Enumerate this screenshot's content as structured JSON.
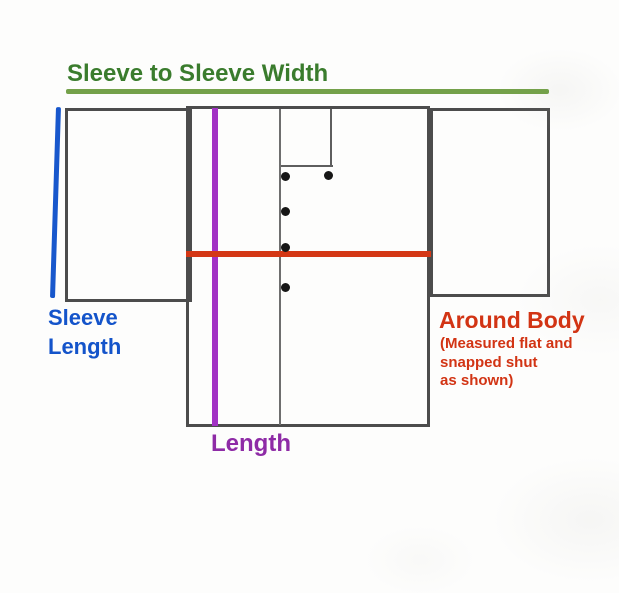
{
  "diagram": {
    "title": "Sleeve to Sleeve Width",
    "measurements": {
      "sleeve_to_sleeve": {
        "label": "Sleeve to Sleeve Width",
        "line_color": "#74a14a",
        "label_color": "#3a7c2d",
        "orientation": "horizontal"
      },
      "sleeve_length": {
        "label": "Sleeve\nLength",
        "line_color": "#1857cc",
        "label_color": "#1454ca",
        "orientation": "vertical"
      },
      "length": {
        "label": "Length",
        "line_color": "#a232c4",
        "label_color": "#8e2ba6",
        "orientation": "vertical"
      },
      "around_body": {
        "label": "Around Body",
        "note": "(Measured flat and\nsnapped shut\nas shown)",
        "line_color": "#d43715",
        "label_color": "#d23414",
        "orientation": "horizontal"
      }
    },
    "garment": {
      "outline_color": "#4c4c4c",
      "snap_count": 5,
      "snap_color": "#161616",
      "pieces": [
        "left-sleeve",
        "body-panel",
        "right-sleeve",
        "collar",
        "front-placket"
      ]
    }
  }
}
